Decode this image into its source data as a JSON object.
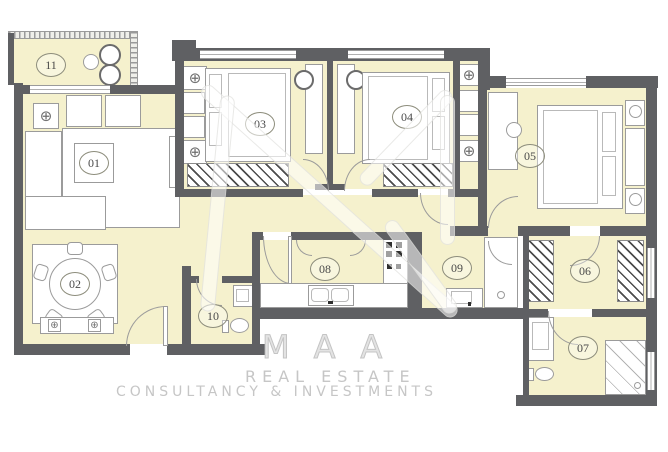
{
  "plan": {
    "rooms": [
      {
        "number": "01"
      },
      {
        "number": "02"
      },
      {
        "number": "03"
      },
      {
        "number": "04"
      },
      {
        "number": "05"
      },
      {
        "number": "06"
      },
      {
        "number": "07"
      },
      {
        "number": "08"
      },
      {
        "number": "09"
      },
      {
        "number": "10"
      },
      {
        "number": "11"
      }
    ],
    "watermark": {
      "brand": "MAA",
      "line1": "REAL ESTATE",
      "line2": "CONSULTANCY & INVESTMENTS"
    },
    "icons": {
      "ceiling_fan": "⊕"
    },
    "colors": {
      "wall": "#5f6063",
      "room_fill": "#f5f1cd",
      "furniture_line": "#9b9b9b",
      "label_text": "#4a4a4a",
      "watermark_text": "#c6c6c6"
    }
  }
}
